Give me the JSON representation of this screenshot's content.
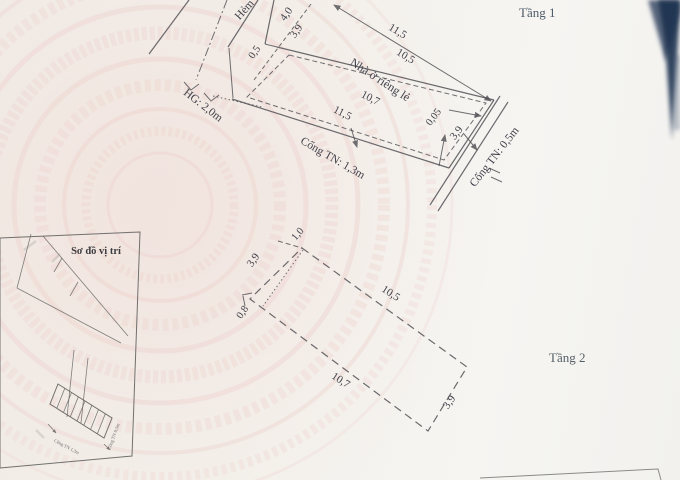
{
  "floor1": {
    "label": "Tầng 1",
    "alley_label": "Hẻm",
    "house_label": "Nhà ở riêng lẻ",
    "boundary_label": "HG: 2,0m",
    "drain_bottom_label": "Cống TN: 1,3m",
    "drain_right_label": "Cống TN: 0,5m",
    "dim_lot_width": "4,0",
    "dim_house_width": "3,9",
    "dim_offset_alley": "0,5",
    "dim_lot_top": "11,5",
    "dim_house_top": "10,5",
    "dim_house_bottom": "10,7",
    "dim_lot_bottom": "11,5",
    "dim_offset_right": "0,05",
    "dim_right_width": "3,9"
  },
  "floor2": {
    "label": "Tầng 2",
    "dim_offset_top": "1,0",
    "dim_left_width": "3,9",
    "dim_offset_bottom": "0,8",
    "dim_top": "10,5",
    "dim_bottom": "10,7",
    "dim_right_width": "3,9"
  },
  "inset": {
    "title": "Sơ đồ vị trí",
    "drain_bottom_label": "Cống TN 1,3m",
    "drain_right_label": "Cống TN 0,5m"
  },
  "colors": {
    "ink": "#4c4c50",
    "paper": "#f3f0ea",
    "watermark": "#eed4d0",
    "photo_edge": "#20304d"
  }
}
